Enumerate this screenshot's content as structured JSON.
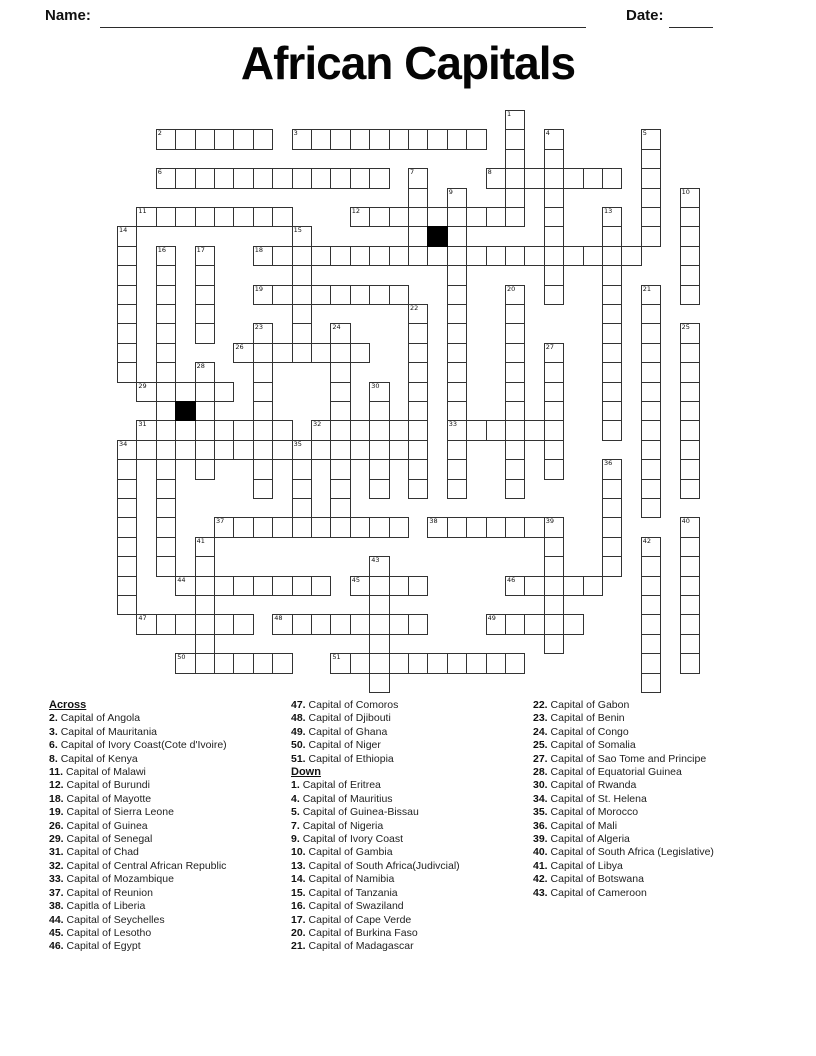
{
  "header": {
    "name_label": "Name:",
    "date_label": "Date:"
  },
  "title": "African Capitals",
  "grid": {
    "cols": 30,
    "rows": 30,
    "pitch": 19.4,
    "origin": {
      "x": 117,
      "y": 110
    },
    "line_color": "#333333",
    "black_cells": [
      [
        16,
        6
      ],
      [
        3,
        15
      ]
    ],
    "words": [
      {
        "n": 2,
        "c": 2,
        "r": 1,
        "len": 6,
        "dir": "a"
      },
      {
        "n": 3,
        "c": 9,
        "r": 1,
        "len": 10,
        "dir": "a"
      },
      {
        "n": 6,
        "c": 2,
        "r": 3,
        "len": 12,
        "dir": "a"
      },
      {
        "n": 8,
        "c": 19,
        "r": 3,
        "len": 7,
        "dir": "a"
      },
      {
        "n": 11,
        "c": 1,
        "r": 5,
        "len": 8,
        "dir": "a"
      },
      {
        "n": 12,
        "c": 12,
        "r": 5,
        "len": 9,
        "dir": "a"
      },
      {
        "n": 18,
        "c": 7,
        "r": 7,
        "len": 20,
        "dir": "a"
      },
      {
        "n": 19,
        "c": 7,
        "r": 9,
        "len": 8,
        "dir": "a"
      },
      {
        "n": 26,
        "c": 6,
        "r": 12,
        "len": 7,
        "dir": "a"
      },
      {
        "n": 29,
        "c": 1,
        "r": 14,
        "len": 5,
        "dir": "a"
      },
      {
        "n": 31,
        "c": 1,
        "r": 16,
        "len": 8,
        "dir": "a"
      },
      {
        "n": 32,
        "c": 10,
        "r": 16,
        "len": 6,
        "dir": "a"
      },
      {
        "n": 33,
        "c": 17,
        "r": 16,
        "len": 6,
        "dir": "a"
      },
      {
        "n": 34,
        "c": 0,
        "r": 17,
        "len": 16,
        "dir": "a"
      },
      {
        "n": 37,
        "c": 5,
        "r": 21,
        "len": 10,
        "dir": "a"
      },
      {
        "n": 38,
        "c": 16,
        "r": 21,
        "len": 7,
        "dir": "a"
      },
      {
        "n": 44,
        "c": 3,
        "r": 24,
        "len": 8,
        "dir": "a"
      },
      {
        "n": 45,
        "c": 12,
        "r": 24,
        "len": 4,
        "dir": "a"
      },
      {
        "n": 46,
        "c": 20,
        "r": 24,
        "len": 5,
        "dir": "a"
      },
      {
        "n": 47,
        "c": 1,
        "r": 26,
        "len": 6,
        "dir": "a"
      },
      {
        "n": 48,
        "c": 8,
        "r": 26,
        "len": 8,
        "dir": "a"
      },
      {
        "n": 49,
        "c": 19,
        "r": 26,
        "len": 5,
        "dir": "a"
      },
      {
        "n": 50,
        "c": 3,
        "r": 28,
        "len": 6,
        "dir": "a"
      },
      {
        "n": 51,
        "c": 11,
        "r": 28,
        "len": 10,
        "dir": "a"
      },
      {
        "n": 1,
        "c": 20,
        "r": 0,
        "len": 6,
        "dir": "d"
      },
      {
        "n": 4,
        "c": 22,
        "r": 1,
        "len": 9,
        "dir": "d"
      },
      {
        "n": 5,
        "c": 27,
        "r": 1,
        "len": 6,
        "dir": "d"
      },
      {
        "n": 7,
        "c": 15,
        "r": 3,
        "len": 5,
        "dir": "d"
      },
      {
        "n": 9,
        "c": 17,
        "r": 4,
        "len": 16,
        "dir": "d"
      },
      {
        "n": 10,
        "c": 29,
        "r": 4,
        "len": 6,
        "dir": "d"
      },
      {
        "n": 13,
        "c": 25,
        "r": 5,
        "len": 12,
        "dir": "d"
      },
      {
        "n": 14,
        "c": 0,
        "r": 6,
        "len": 8,
        "dir": "d"
      },
      {
        "n": 15,
        "c": 9,
        "r": 6,
        "len": 6,
        "dir": "d"
      },
      {
        "n": 16,
        "c": 2,
        "r": 7,
        "len": 17,
        "dir": "d"
      },
      {
        "n": 17,
        "c": 4,
        "r": 7,
        "len": 5,
        "dir": "d"
      },
      {
        "n": 20,
        "c": 20,
        "r": 9,
        "len": 11,
        "dir": "d"
      },
      {
        "n": 21,
        "c": 27,
        "r": 9,
        "len": 12,
        "dir": "d"
      },
      {
        "n": 22,
        "c": 15,
        "r": 10,
        "len": 10,
        "dir": "d"
      },
      {
        "n": 23,
        "c": 7,
        "r": 11,
        "len": 9,
        "dir": "d"
      },
      {
        "n": 24,
        "c": 11,
        "r": 11,
        "len": 11,
        "dir": "d"
      },
      {
        "n": 25,
        "c": 29,
        "r": 11,
        "len": 9,
        "dir": "d"
      },
      {
        "n": 27,
        "c": 22,
        "r": 12,
        "len": 7,
        "dir": "d"
      },
      {
        "n": 28,
        "c": 4,
        "r": 13,
        "len": 6,
        "dir": "d"
      },
      {
        "n": 30,
        "c": 13,
        "r": 14,
        "len": 6,
        "dir": "d"
      },
      {
        "n": 34,
        "c": 0,
        "r": 17,
        "len": 9,
        "dir": "d"
      },
      {
        "n": 35,
        "c": 9,
        "r": 17,
        "len": 5,
        "dir": "d"
      },
      {
        "n": 36,
        "c": 25,
        "r": 18,
        "len": 6,
        "dir": "d"
      },
      {
        "n": 39,
        "c": 22,
        "r": 21,
        "len": 7,
        "dir": "d"
      },
      {
        "n": 40,
        "c": 29,
        "r": 21,
        "len": 8,
        "dir": "d"
      },
      {
        "n": 41,
        "c": 4,
        "r": 22,
        "len": 7,
        "dir": "d"
      },
      {
        "n": 42,
        "c": 27,
        "r": 22,
        "len": 8,
        "dir": "d"
      },
      {
        "n": 43,
        "c": 13,
        "r": 23,
        "len": 7,
        "dir": "d"
      }
    ]
  },
  "clues": {
    "across_label": "Across",
    "down_label": "Down",
    "across": [
      {
        "n": "2",
        "text": "Capital of Angola"
      },
      {
        "n": "3",
        "text": "Capital of Mauritania"
      },
      {
        "n": "6",
        "text": "Capital of Ivory Coast(Cote d'Ivoire)"
      },
      {
        "n": "8",
        "text": "Capital of Kenya"
      },
      {
        "n": "11",
        "text": "Capital of Malawi"
      },
      {
        "n": "12",
        "text": "Capital of Burundi"
      },
      {
        "n": "18",
        "text": "Capital of Mayotte"
      },
      {
        "n": "19",
        "text": "Capital of Sierra Leone"
      },
      {
        "n": "26",
        "text": "Capital of Guinea"
      },
      {
        "n": "29",
        "text": "Capital of Senegal"
      },
      {
        "n": "31",
        "text": "Capital of Chad"
      },
      {
        "n": "32",
        "text": "Capital of Central African Republic"
      },
      {
        "n": "33",
        "text": "Capital of Mozambique"
      },
      {
        "n": "37",
        "text": "Capital of Reunion"
      },
      {
        "n": "38",
        "text": "Capitla of Liberia"
      },
      {
        "n": "44",
        "text": "Capital of Seychelles"
      },
      {
        "n": "45",
        "text": "Capital of Lesotho"
      },
      {
        "n": "46",
        "text": "Capital of Egypt"
      },
      {
        "n": "47",
        "text": "Capital of Comoros"
      },
      {
        "n": "48",
        "text": "Capital of Djibouti"
      },
      {
        "n": "49",
        "text": "Capital of Ghana"
      },
      {
        "n": "50",
        "text": "Capital of Niger"
      },
      {
        "n": "51",
        "text": "Capital of Ethiopia"
      }
    ],
    "down": [
      {
        "n": "1",
        "text": "Capital of Eritrea"
      },
      {
        "n": "4",
        "text": "Capital of Mauritius"
      },
      {
        "n": "5",
        "text": "Capital of Guinea-Bissau"
      },
      {
        "n": "7",
        "text": "Capital of Nigeria"
      },
      {
        "n": "9",
        "text": "Capital of Ivory Coast"
      },
      {
        "n": "10",
        "text": "Capital of Gambia"
      },
      {
        "n": "13",
        "text": "Capital of South Africa(Judivcial)"
      },
      {
        "n": "14",
        "text": "Capital of Namibia"
      },
      {
        "n": "15",
        "text": "Capital of Tanzania"
      },
      {
        "n": "16",
        "text": "Capital of Swaziland"
      },
      {
        "n": "17",
        "text": "Capital of Cape Verde"
      },
      {
        "n": "20",
        "text": "Capital of Burkina Faso"
      },
      {
        "n": "21",
        "text": "Capital of Madagascar"
      },
      {
        "n": "22",
        "text": "Capital of Gabon"
      },
      {
        "n": "23",
        "text": "Capital of Benin"
      },
      {
        "n": "24",
        "text": "Capital of Congo"
      },
      {
        "n": "25",
        "text": "Capital of Somalia"
      },
      {
        "n": "27",
        "text": "Capital of Sao Tome and Principe"
      },
      {
        "n": "28",
        "text": "Capital of Equatorial Guinea"
      },
      {
        "n": "30",
        "text": "Capital of Rwanda"
      },
      {
        "n": "34",
        "text": "Capital of St. Helena"
      },
      {
        "n": "35",
        "text": "Capital of Morocco"
      },
      {
        "n": "36",
        "text": "Capital of Mali"
      },
      {
        "n": "39",
        "text": "Capital of Algeria"
      },
      {
        "n": "40",
        "text": "Capital of South Africa (Legislative)"
      },
      {
        "n": "41",
        "text": "Capital of Libya"
      },
      {
        "n": "42",
        "text": "Capital of Botswana"
      },
      {
        "n": "43",
        "text": "Capital of Cameroon"
      }
    ]
  }
}
